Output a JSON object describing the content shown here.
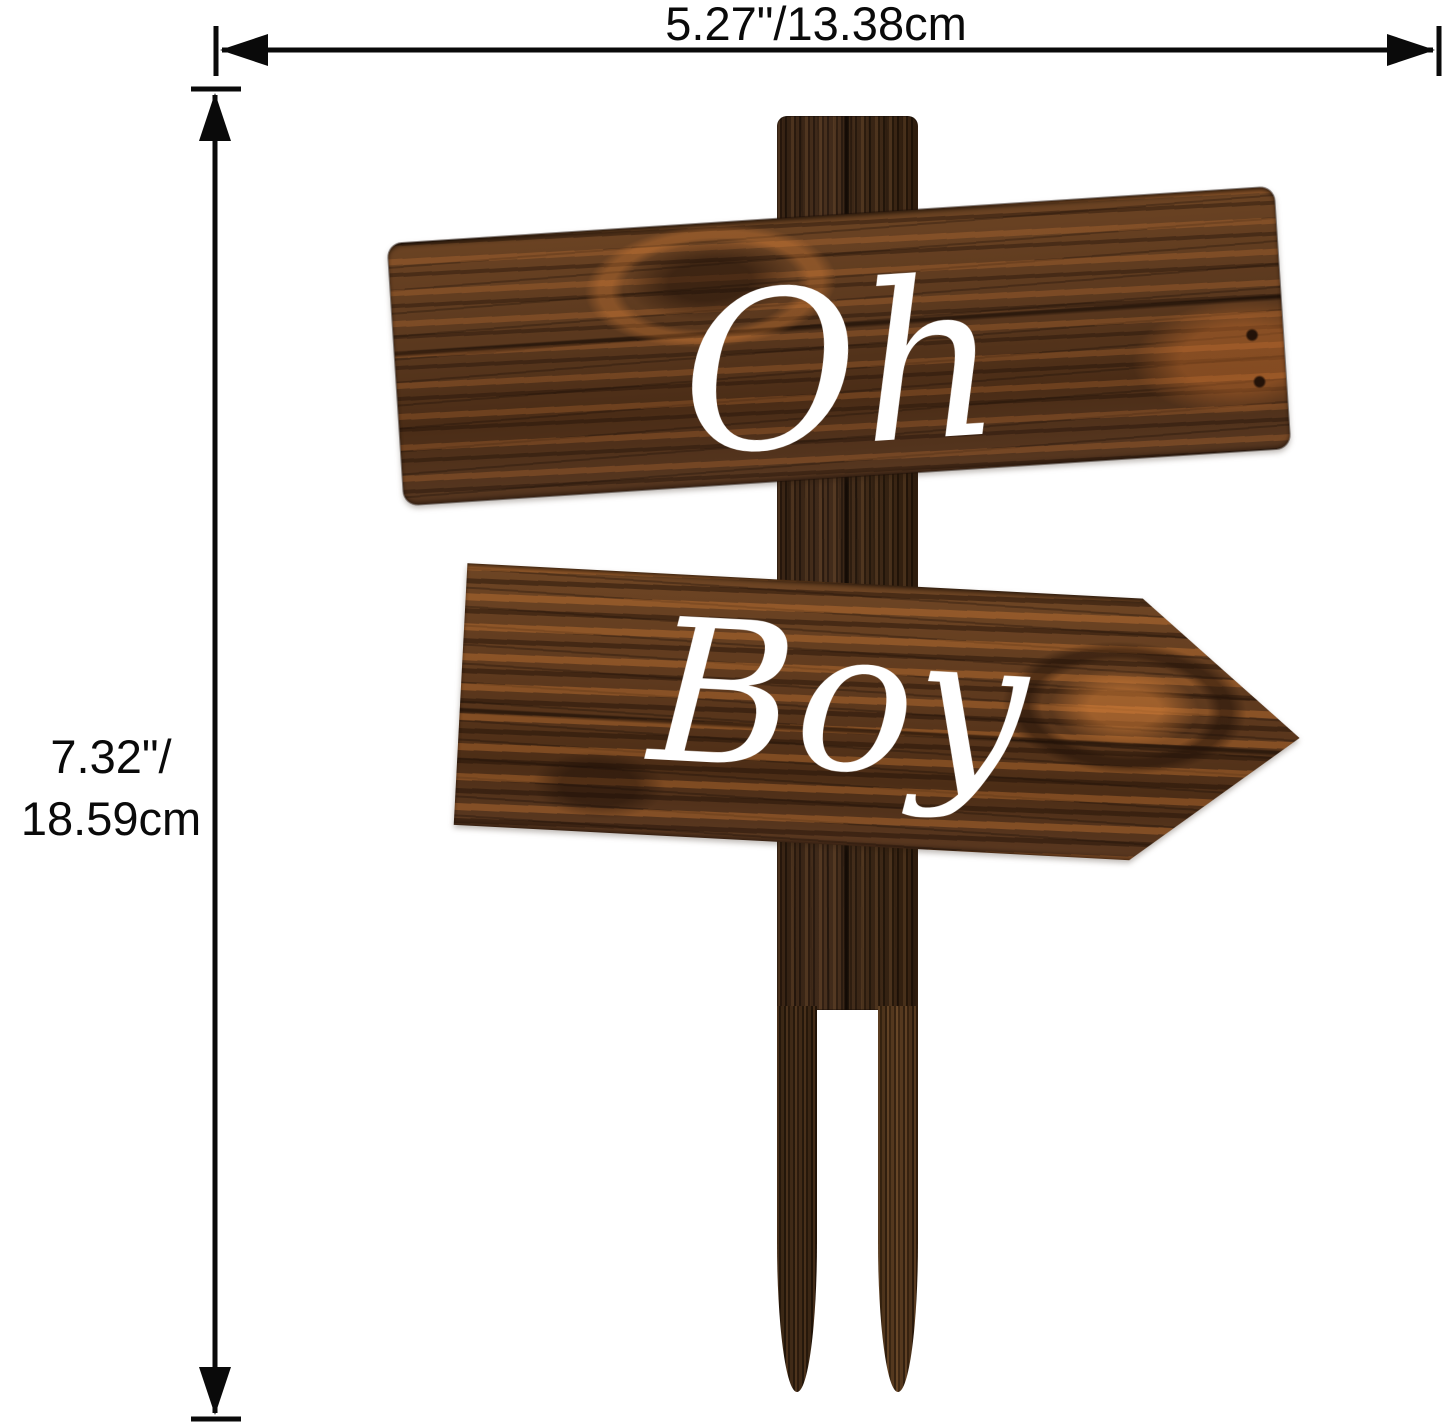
{
  "dimensions": {
    "width_label": "5.27\"/13.38cm",
    "height_label_line1": "7.32\"/",
    "height_label_line2": "18.59cm"
  },
  "sign": {
    "top_board_text": "Oh",
    "bottom_board_text": "Boy"
  },
  "icons": {
    "arrowhead_left": "left-pointing filled triangle",
    "arrowhead_right": "right-pointing filled triangle",
    "arrowhead_up": "up-pointing filled triangle",
    "arrowhead_down": "down-pointing filled triangle"
  },
  "colors": {
    "background": "#ffffff",
    "dimension_line": "#0a0a0a",
    "post_wood_dark": "#3a2615",
    "board_wood_base": "#5a381e",
    "board_wood_highlight": "#c07a3c",
    "sign_text": "#ffffff"
  }
}
